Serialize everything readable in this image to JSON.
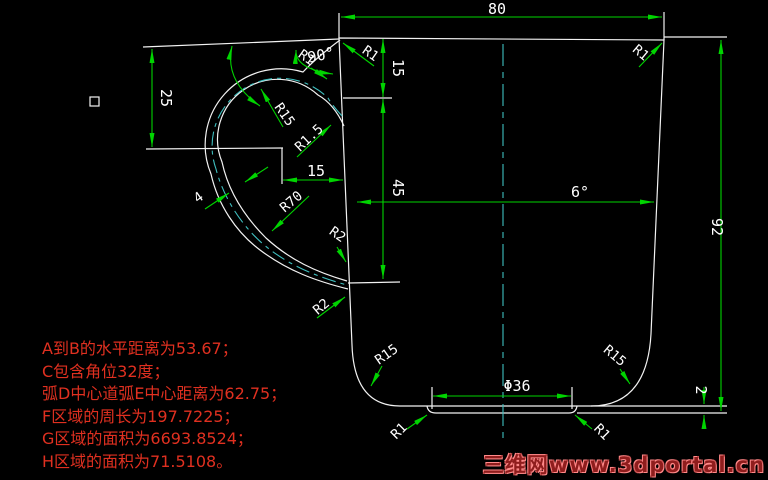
{
  "colors": {
    "background": "#000000",
    "geometry": "#f2f2f2",
    "dimension_lines": "#00d400",
    "dimension_text": "#ffffff",
    "centerline": "#3fbfbf",
    "notes_text": "#e03020",
    "watermark_text": "#8f1d1d"
  },
  "dimensions": {
    "width_top": "80",
    "left_height": "25",
    "vert_upper": "15",
    "vert_lower": "45",
    "horiz_handle": "15",
    "angle_handle": "90°",
    "angle_taper": "6°",
    "height_right": "92",
    "base_thickness": "2",
    "foot_diameter": "Φ36",
    "handle_thickness": "4",
    "r1_handle_outer": "R1",
    "r1_top_left_corner": "R1",
    "r1_top_right_corner": "R1",
    "r15_handle_loop": "R15",
    "r1_5_handle_inner": "R1.5",
    "r70_handle_sweep": "R70",
    "r2_attach_upper": "R2",
    "r2_attach_lower": "R2",
    "r15_bottom_left": "R15",
    "r15_bottom_right": "R15",
    "r1_foot_left": "R1",
    "r1_foot_right": "R1"
  },
  "notes": {
    "lines": [
      "A到B的水平距离为53.67；",
      "C包含角位32度；",
      "弧D中心道弧E中心距离为62.75；",
      "F区域的周长为197.7225；",
      "G区域的面积为6693.8524；",
      "H区域的面积为71.5108。"
    ]
  },
  "watermark": {
    "text": "三维网www.3dportal.cn"
  }
}
